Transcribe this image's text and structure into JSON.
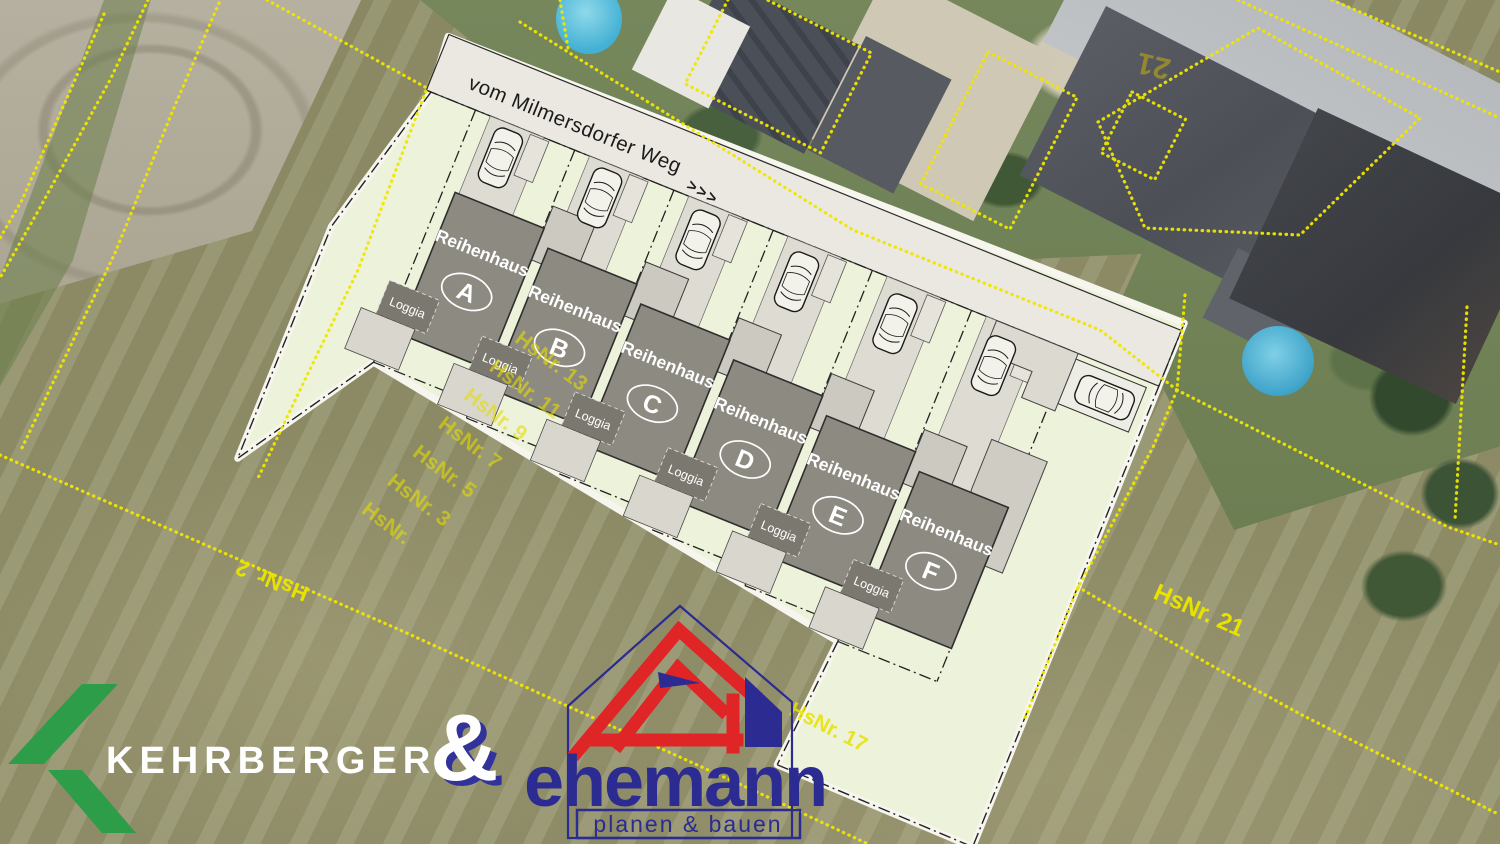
{
  "plan": {
    "street": {
      "label": "vom Milmersdorfer Weg",
      "arrows": ">>>"
    },
    "houses": [
      {
        "name": "Reihenhaus",
        "letter": "A",
        "loggia": "Loggia"
      },
      {
        "name": "Reihenhaus",
        "letter": "B",
        "loggia": "Loggia"
      },
      {
        "name": "Reihenhaus",
        "letter": "C",
        "loggia": "Loggia"
      },
      {
        "name": "Reihenhaus",
        "letter": "D",
        "loggia": "Loggia"
      },
      {
        "name": "Reihenhaus",
        "letter": "E",
        "loggia": "Loggia"
      },
      {
        "name": "Reihenhaus",
        "letter": "F",
        "loggia": "Loggia"
      }
    ]
  },
  "parcel_labels": {
    "stack": [
      "HsNr. 13",
      "HsNr. 11",
      "HsNr. 9",
      "HsNr. 7",
      "HsNr. 5",
      "HsNr. 3",
      "HsNr."
    ],
    "left": "HsNr. 2",
    "right": "HsNr. 21",
    "center": "HsNr. 17",
    "roof": "21"
  },
  "branding": {
    "kehrberger": {
      "name": "KEHRBERGER"
    },
    "ampersand": "&",
    "ehemann": {
      "name": "ehemann",
      "tagline": "planen & bauen"
    }
  },
  "colors": {
    "boundary_yellow": "#f0e600",
    "kehrberger_green": "#2d9d49",
    "ehemann_navy": "#2b2b91",
    "ehemann_red": "#df2525",
    "house_gray": "#8d8a82",
    "site_pale": "#edf2da"
  }
}
